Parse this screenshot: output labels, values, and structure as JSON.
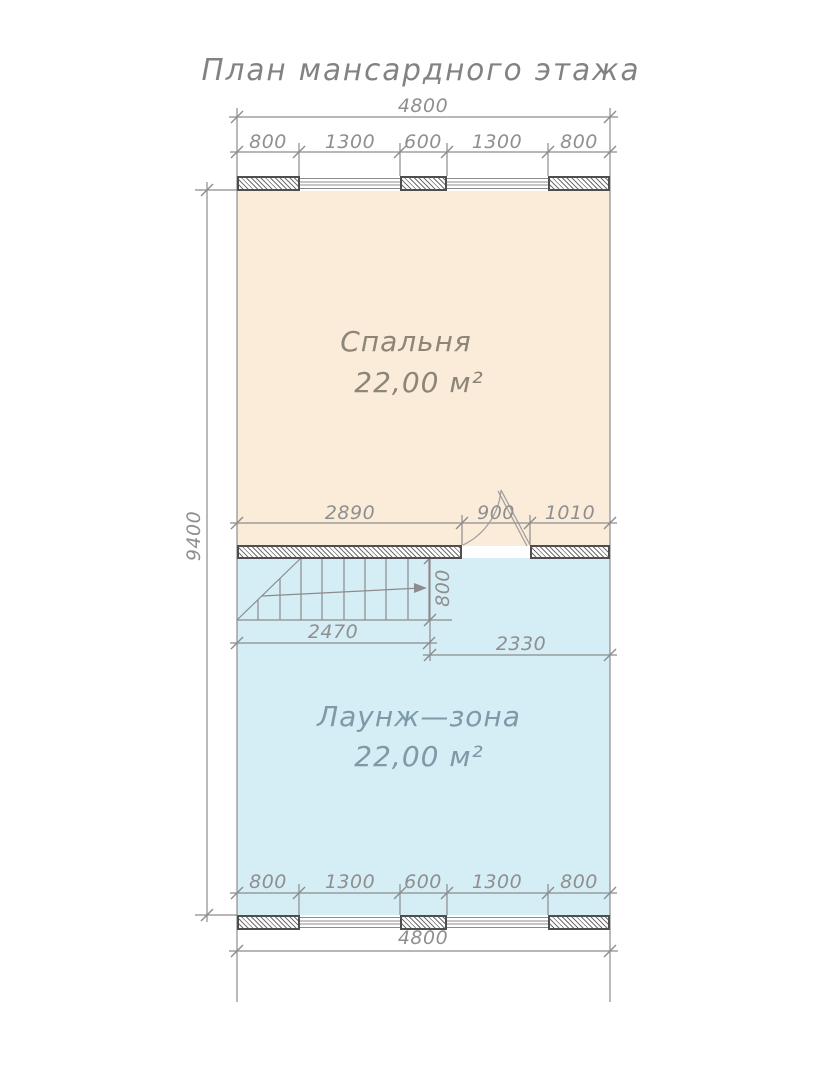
{
  "title": "План мансардного этажа",
  "rooms": {
    "bedroom": {
      "name": "Спальня",
      "area": "22,00 м²"
    },
    "lounge": {
      "name": "Лаунж—зона",
      "area": "22,00 м²"
    }
  },
  "dimensions": {
    "top_overall": "4800",
    "top_segments": [
      "800",
      "1300",
      "600",
      "1300",
      "800"
    ],
    "left_overall": "9400",
    "interior_wall": [
      "2890",
      "900",
      "1010"
    ],
    "stairs_width": "2470",
    "stairs_depth": "800",
    "right_of_stairs": "2330",
    "bottom_segments": [
      "800",
      "1300",
      "600",
      "1300",
      "800"
    ],
    "bottom_overall": "4800"
  },
  "colors": {
    "bedroom_fill": "#faecd8",
    "lounge_fill": "#d5edf4",
    "wall_outline": "#4e4e4e",
    "line": "#8c8c8c",
    "dim_text": "#8f8f8f",
    "title_text": "#828282",
    "bedroom_text": "#8d8578",
    "lounge_text": "#7e9aa8"
  }
}
